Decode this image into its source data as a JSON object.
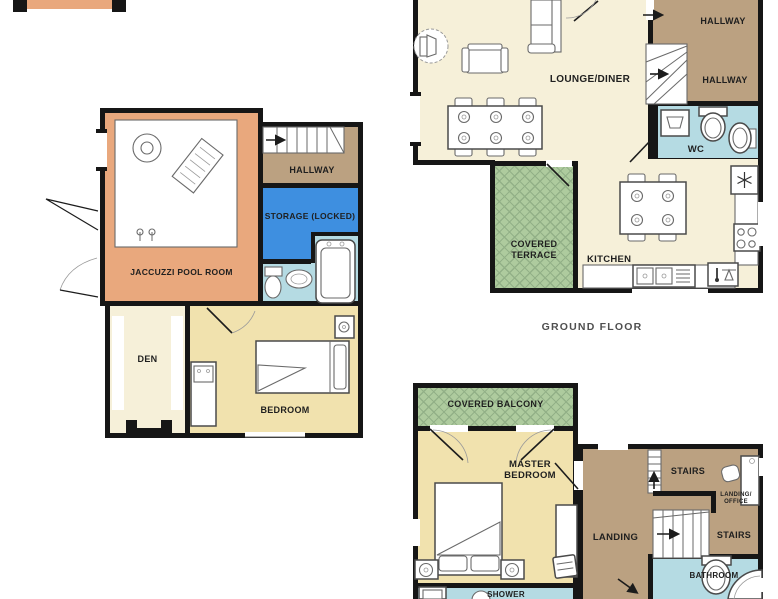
{
  "canvas": {
    "width": 778,
    "height": 599
  },
  "colors": {
    "wall": "#161616",
    "pool_room": "#E9A87D",
    "hallway": "#BBA181",
    "storage": "#3E8FE0",
    "water": "#B5DBE3",
    "cream": "#F6F0D9",
    "bedroom": "#F1E2AE",
    "terrace": "#AECB9E",
    "terrace_line": "#92B087",
    "label": "#1f1f1f",
    "caption": "#4f4f4f"
  },
  "lower_plan": {
    "pool_room_label": "JACCUZZI POOL ROOM",
    "hallway_label": "HALLWAY",
    "storage_label": "STORAGE (LOCKED)",
    "den_label": "DEN",
    "bedroom_label": "BEDROOM"
  },
  "ground_floor": {
    "caption": "GROUND FLOOR",
    "lounge_label": "LOUNGE/DINER",
    "hallway_top_label": "HALLWAY",
    "hallway_mid_label": "HALLWAY",
    "wc_label": "WC",
    "terrace_label_line1": "COVERED",
    "terrace_label_line2": "TERRACE",
    "kitchen_label": "KITCHEN"
  },
  "first_floor": {
    "balcony_label": "COVERED BALCONY",
    "master_label_line1": "MASTER",
    "master_label_line2": "BEDROOM",
    "landing_label": "LANDING",
    "stairs_top_label": "STAIRS",
    "landing_office_label_line1": "LANDING/",
    "landing_office_label_line2": "OFFICE",
    "stairs_mid_label": "STAIRS",
    "bathroom_label": "BATHROOM",
    "shower_label": "SHOWER"
  },
  "icons": {
    "fridge": "snowflake-icon",
    "hob": "hob-rings-icon",
    "stairs_arrow": "direction-arrow-icon"
  }
}
